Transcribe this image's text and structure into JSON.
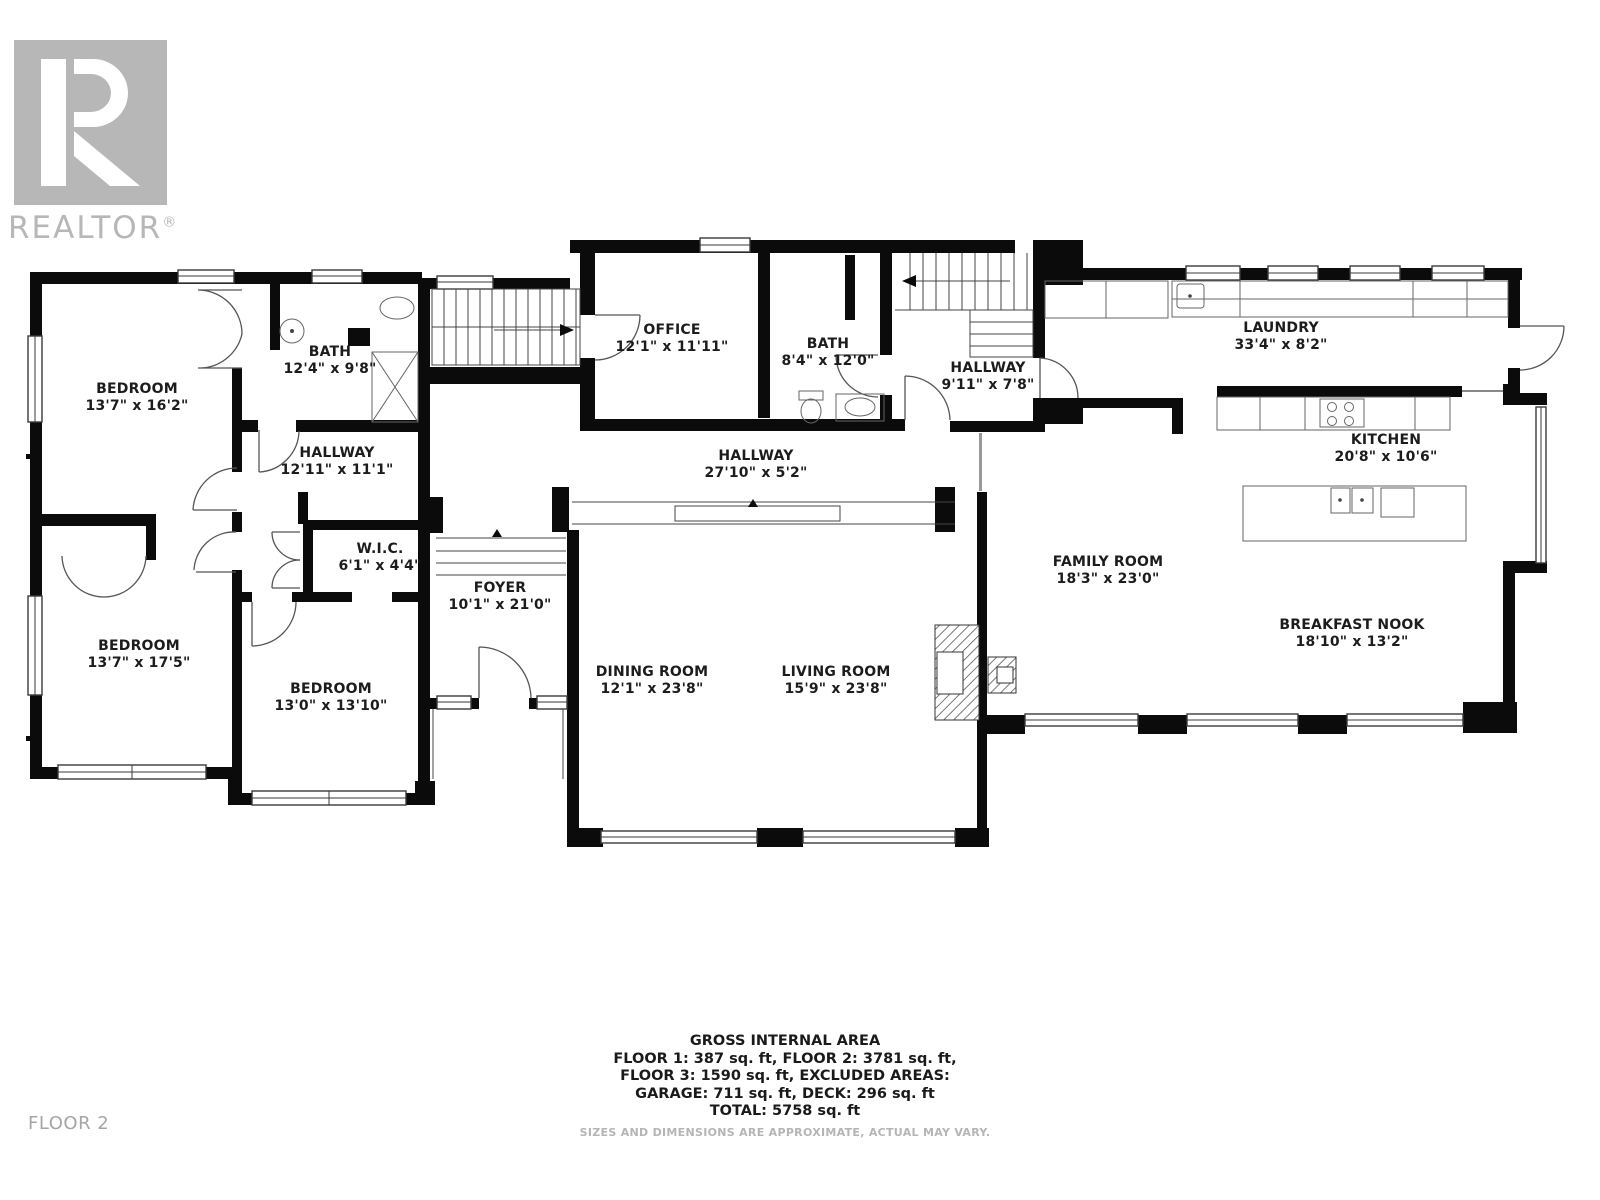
{
  "logo": {
    "brand": "REALTOR",
    "reg": "®"
  },
  "floor_label": "FLOOR 2",
  "rooms": [
    {
      "name": "BEDROOM",
      "dims": "13'7\" x 16'2\""
    },
    {
      "name": "BATH",
      "dims": "12'4\" x 9'8\""
    },
    {
      "name": "HALLWAY",
      "dims": "12'11\" x 11'1\""
    },
    {
      "name": "W.I.C.",
      "dims": "6'1\" x 4'4\""
    },
    {
      "name": "BEDROOM",
      "dims": "13'7\" x 17'5\""
    },
    {
      "name": "BEDROOM",
      "dims": "13'0\" x 13'10\""
    },
    {
      "name": "FOYER",
      "dims": "10'1\" x 21'0\""
    },
    {
      "name": "OFFICE",
      "dims": "12'1\" x 11'11\""
    },
    {
      "name": "BATH",
      "dims": "8'4\" x 12'0\""
    },
    {
      "name": "HALLWAY",
      "dims": "9'11\" x 7'8\""
    },
    {
      "name": "HALLWAY",
      "dims": "27'10\" x 5'2\""
    },
    {
      "name": "DINING ROOM",
      "dims": "12'1\" x 23'8\""
    },
    {
      "name": "LIVING ROOM",
      "dims": "15'9\" x 23'8\""
    },
    {
      "name": "LAUNDRY",
      "dims": "33'4\" x 8'2\""
    },
    {
      "name": "KITCHEN",
      "dims": "20'8\" x 10'6\""
    },
    {
      "name": "FAMILY ROOM",
      "dims": "18'3\" x 23'0\""
    },
    {
      "name": "BREAKFAST NOOK",
      "dims": "18'10\" x 13'2\""
    }
  ],
  "summary": {
    "title": "GROSS INTERNAL AREA",
    "line1": "FLOOR 1: 387 sq. ft, FLOOR 2: 3781 sq. ft,",
    "line2": "FLOOR 3: 1590 sq. ft, EXCLUDED AREAS:",
    "line3": "GARAGE: 711 sq. ft, DECK: 296 sq. ft",
    "total": "TOTAL: 5758 sq. ft"
  },
  "disclaimer": "SIZES AND DIMENSIONS ARE APPROXIMATE, ACTUAL MAY VARY."
}
